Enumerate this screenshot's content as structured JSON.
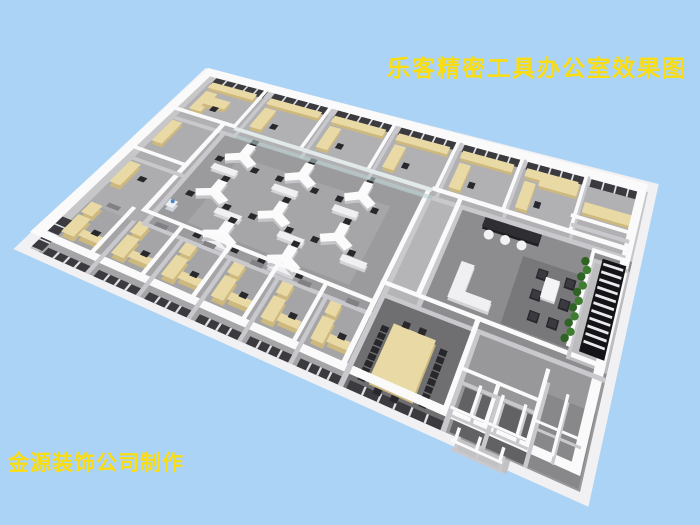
{
  "canvas": {
    "width": 700,
    "height": 525,
    "background": "#abd3f5"
  },
  "title": {
    "text": "乐客精密工具办公室效果图",
    "color": "#fbdd10"
  },
  "credit": {
    "text": "金源装饰公司制作",
    "color": "#fbdd10"
  },
  "scene": {
    "type": "3d-office-floorplan-render",
    "rooms": [
      "private-offices-top-row",
      "open-office",
      "corridor",
      "pantry-bar",
      "reception-lounge",
      "stairwell",
      "plant-wall",
      "conference-room",
      "private-offices-bottom-row",
      "storage-rooms",
      "restrooms"
    ],
    "quad": {
      "n": [
        208,
        76
      ],
      "e": [
        648,
        192
      ],
      "s": [
        580,
        492
      ],
      "w": [
        30,
        248
      ]
    },
    "plan_size": [
      520,
      300
    ],
    "palette": {
      "slab": "#f1f1f3",
      "wall_top": "#fafafb",
      "wall_side": "#c9c9cd",
      "glass": "#b9cfcf",
      "glass_top": "#e4ecec",
      "window": "#3a3a3f",
      "mullion": "#dfe0e3",
      "desk": "#e9d9a4",
      "desk_side": "#cdb87e",
      "chair": "#28282c",
      "ydesk": "#fbfbfc",
      "ydesk_side": "#c6c6ca",
      "cabinet": "#f0f0f2",
      "cabinet_side": "#d4d4d8",
      "plant": "#3e7d2f",
      "plant_dark": "#2f6323",
      "stair": "#141418",
      "step": "#e9e9ec",
      "door": "#808085",
      "counter_dark": "#2e2e33",
      "counter_dark_side": "#1f1f23"
    },
    "floors": [
      {
        "r": [
          0,
          0,
          520,
          300
        ],
        "c": "#c7c7ca"
      },
      {
        "r": [
          8,
          9,
          504,
          61
        ],
        "c": "#b1b1b4"
      },
      {
        "r": [
          8,
          70,
          57,
          145
        ],
        "c": "#adadb0"
      },
      {
        "r": [
          65,
          70,
          228,
          145
        ],
        "c": "#9b9b9e"
      },
      {
        "r": [
          95,
          92,
          165,
          100
        ],
        "c": "#a6a6a9"
      },
      {
        "r": [
          293,
          70,
          37,
          148
        ],
        "c": "#b5b5b8"
      },
      {
        "r": [
          330,
          70,
          190,
          148
        ],
        "c": "#8d8d90"
      },
      {
        "r": [
          408,
          98,
          74,
          74
        ],
        "c": "#78787b"
      },
      {
        "r": [
          8,
          215,
          287,
          85
        ],
        "c": "#a5a5a8"
      },
      {
        "r": [
          295,
          190,
          97,
          110
        ],
        "c": "#6f6f72"
      },
      {
        "r": [
          392,
          190,
          128,
          110
        ],
        "c": "#98989b"
      },
      {
        "r": [
          396,
          248,
          70,
          50
        ],
        "c": "#626265"
      },
      {
        "r": [
          468,
          222,
          50,
          76
        ],
        "c": "#88888b"
      },
      {
        "r": [
          482,
          80,
          38,
          102
        ],
        "c": "#bdbdc0"
      },
      {
        "r": [
          404,
          300,
          50,
          14
        ],
        "c": "#c2c2c5"
      }
    ],
    "windows": [
      {
        "r": [
          10,
          0,
          61,
          10
        ],
        "m": 4
      },
      {
        "r": [
          79,
          0,
          67,
          10
        ],
        "m": 4
      },
      {
        "r": [
          154,
          0,
          67,
          10
        ],
        "m": 4
      },
      {
        "r": [
          229,
          0,
          67,
          10
        ],
        "m": 4
      },
      {
        "r": [
          304,
          0,
          67,
          10
        ],
        "m": 4
      },
      {
        "r": [
          379,
          0,
          67,
          10
        ],
        "m": 4
      },
      {
        "r": [
          454,
          0,
          58,
          10
        ],
        "m": 3
      },
      {
        "r": [
          12,
          290,
          40,
          10
        ],
        "m": 3
      },
      {
        "r": [
          60,
          290,
          40,
          10
        ],
        "m": 3
      },
      {
        "r": [
          108,
          290,
          40,
          10
        ],
        "m": 3
      },
      {
        "r": [
          156,
          290,
          40,
          10
        ],
        "m": 3
      },
      {
        "r": [
          204,
          290,
          40,
          10
        ],
        "m": 3
      },
      {
        "r": [
          252,
          290,
          39,
          10
        ],
        "m": 3
      },
      {
        "r": [
          299,
          290,
          89,
          10
        ],
        "m": 5
      },
      {
        "r": [
          0,
          245,
          10,
          52
        ],
        "m": 3
      }
    ],
    "walls": [
      {
        "r": [
          0,
          0,
          520,
          10
        ],
        "rim": 1
      },
      {
        "r": [
          510,
          0,
          10,
          300
        ],
        "rim": 1
      },
      {
        "r": [
          0,
          290,
          520,
          10
        ],
        "rim": 1
      },
      {
        "r": [
          0,
          0,
          10,
          300
        ],
        "rim": 1
      },
      {
        "r": [
          73,
          0,
          4,
          70
        ]
      },
      {
        "r": [
          148,
          0,
          4,
          70
        ]
      },
      {
        "r": [
          223,
          0,
          4,
          70
        ]
      },
      {
        "r": [
          298,
          0,
          4,
          70
        ]
      },
      {
        "r": [
          373,
          0,
          4,
          70
        ]
      },
      {
        "r": [
          448,
          0,
          4,
          70
        ]
      },
      {
        "r": [
          8,
          66,
          69,
          5
        ]
      },
      {
        "r": [
          296,
          66,
          216,
          5
        ]
      },
      {
        "r": [
          61,
          70,
          5,
          145
        ]
      },
      {
        "r": [
          8,
          136,
          55,
          5
        ]
      },
      {
        "r": [
          61,
          211,
          234,
          5
        ]
      },
      {
        "r": [
          291,
          70,
          5,
          230
        ]
      },
      {
        "r": [
          326,
          70,
          5,
          118
        ]
      },
      {
        "r": [
          291,
          186,
          229,
          5
        ]
      },
      {
        "r": [
          388,
          186,
          5,
          114
        ]
      },
      {
        "r": [
          426,
          243,
          4,
          57
        ]
      },
      {
        "r": [
          390,
          243,
          78,
          4
        ]
      },
      {
        "r": [
          466,
          211,
          4,
          89
        ]
      },
      {
        "r": [
          480,
          78,
          38,
          4
        ]
      },
      {
        "r": [
          478,
          78,
          4,
          104
        ]
      },
      {
        "r": [
          446,
          50,
          66,
          4
        ]
      },
      {
        "r": [
          52,
          215,
          4,
          85
        ]
      },
      {
        "r": [
          100,
          215,
          4,
          85
        ]
      },
      {
        "r": [
          148,
          215,
          4,
          85
        ]
      },
      {
        "r": [
          196,
          215,
          4,
          85
        ]
      },
      {
        "r": [
          244,
          215,
          4,
          85
        ]
      },
      {
        "r": [
          410,
          248,
          3,
          32
        ],
        "s": 1
      },
      {
        "r": [
          432,
          248,
          3,
          32
        ],
        "s": 1
      },
      {
        "r": [
          454,
          248,
          3,
          32
        ],
        "s": 1
      },
      {
        "r": [
          392,
          280,
          74,
          3
        ],
        "s": 1
      },
      {
        "r": [
          468,
          258,
          44,
          3
        ],
        "s": 1
      },
      {
        "r": [
          489,
          222,
          3,
          64
        ],
        "s": 1
      },
      {
        "r": [
          404,
          298,
          3,
          16
        ],
        "s": 1
      },
      {
        "r": [
          424,
          298,
          3,
          16
        ],
        "s": 1
      },
      {
        "r": [
          446,
          298,
          3,
          16
        ],
        "s": 1
      },
      {
        "r": [
          402,
          312,
          48,
          3
        ],
        "s": 1
      }
    ],
    "glass_walls": [
      {
        "r": [
          75,
          66,
          221,
          5
        ]
      }
    ],
    "desks": [
      [
        14,
        12,
        52,
        9
      ],
      [
        82,
        12,
        60,
        9
      ],
      [
        157,
        12,
        60,
        9
      ],
      [
        232,
        12,
        60,
        9
      ],
      [
        307,
        12,
        60,
        9
      ],
      [
        382,
        12,
        60,
        9
      ],
      [
        16,
        26,
        13,
        30
      ],
      [
        84,
        26,
        13,
        30
      ],
      [
        159,
        26,
        13,
        30
      ],
      [
        234,
        26,
        13,
        30
      ],
      [
        309,
        26,
        13,
        30
      ],
      [
        384,
        26,
        13,
        30
      ],
      [
        22,
        32,
        26,
        12
      ],
      [
        400,
        14,
        44,
        13
      ],
      [
        455,
        30,
        57,
        11
      ],
      [
        14,
        220,
        11,
        18
      ],
      [
        62,
        220,
        11,
        18
      ],
      [
        110,
        220,
        11,
        18
      ],
      [
        158,
        220,
        11,
        18
      ],
      [
        206,
        220,
        11,
        18
      ],
      [
        254,
        220,
        11,
        18
      ],
      [
        14,
        242,
        12,
        30
      ],
      [
        62,
        242,
        12,
        30
      ],
      [
        110,
        242,
        12,
        30
      ],
      [
        158,
        242,
        12,
        30
      ],
      [
        206,
        242,
        12,
        30
      ],
      [
        254,
        242,
        12,
        30
      ],
      [
        28,
        258,
        20,
        10
      ],
      [
        76,
        258,
        20,
        10
      ],
      [
        124,
        258,
        20,
        10
      ],
      [
        172,
        258,
        20,
        10
      ],
      [
        220,
        258,
        20,
        10
      ],
      [
        268,
        258,
        20,
        10
      ],
      [
        12,
        78,
        11,
        36
      ],
      [
        12,
        150,
        11,
        36
      ]
    ],
    "white_cabinets": [
      [
        80,
        114,
        26,
        8
      ],
      [
        145,
        114,
        26,
        8
      ],
      [
        210,
        114,
        26,
        8
      ],
      [
        112,
        166,
        26,
        8
      ],
      [
        177,
        166,
        26,
        8
      ],
      [
        242,
        166,
        26,
        8
      ],
      [
        120,
        204,
        26,
        8
      ],
      [
        185,
        204,
        26,
        8
      ],
      [
        352,
        128,
        14,
        42
      ],
      [
        366,
        158,
        28,
        12
      ]
    ],
    "chairs": [
      [
        34,
        42
      ],
      [
        102,
        42
      ],
      [
        177,
        42
      ],
      [
        252,
        42
      ],
      [
        327,
        42
      ],
      [
        402,
        42
      ],
      [
        34,
        250
      ],
      [
        82,
        250
      ],
      [
        130,
        250
      ],
      [
        178,
        250
      ],
      [
        226,
        250
      ],
      [
        274,
        250
      ],
      [
        30,
        162
      ]
    ],
    "armchairs": [
      [
        428,
        108
      ],
      [
        428,
        130
      ],
      [
        458,
        108
      ],
      [
        458,
        130
      ],
      [
        432,
        152
      ],
      [
        452,
        152
      ]
    ],
    "ydesk_clusters": [
      [
        100,
        95
      ],
      [
        165,
        95
      ],
      [
        230,
        95
      ],
      [
        100,
        150
      ],
      [
        165,
        150
      ],
      [
        230,
        150
      ],
      [
        132,
        196
      ],
      [
        197,
        196
      ]
    ],
    "conference": {
      "table": [
        316,
        220,
        42,
        68
      ],
      "chair_cols": [
        306,
        364
      ],
      "chair_rows": [
        224,
        232.5,
        241,
        249.5,
        258,
        266.5,
        275,
        283.5
      ],
      "chair_ends": [
        [
          323,
          211
        ],
        [
          339,
          211
        ],
        [
          323,
          291
        ],
        [
          339,
          291
        ]
      ]
    },
    "stools": [
      [
        368,
        92
      ],
      [
        386,
        92
      ],
      [
        404,
        92
      ]
    ],
    "counter_dark": [
      358,
      72,
      62,
      13
    ],
    "coffee_table": [
      438,
      114,
      15,
      22
    ],
    "plant_wall": {
      "x": 475,
      "y0": 88,
      "y1": 168,
      "step": 8
    },
    "stairs": {
      "r": [
        490,
        80,
        26,
        96
      ],
      "steps": 11
    },
    "water_dispenser": [
      70,
      178,
      8,
      10
    ],
    "doors": [
      [
        26,
        210,
        12,
        6
      ],
      [
        74,
        210,
        12,
        6
      ],
      [
        122,
        210,
        12,
        6
      ],
      [
        170,
        210,
        12,
        6
      ],
      [
        218,
        210,
        12,
        6
      ],
      [
        266,
        210,
        12,
        6
      ]
    ]
  }
}
